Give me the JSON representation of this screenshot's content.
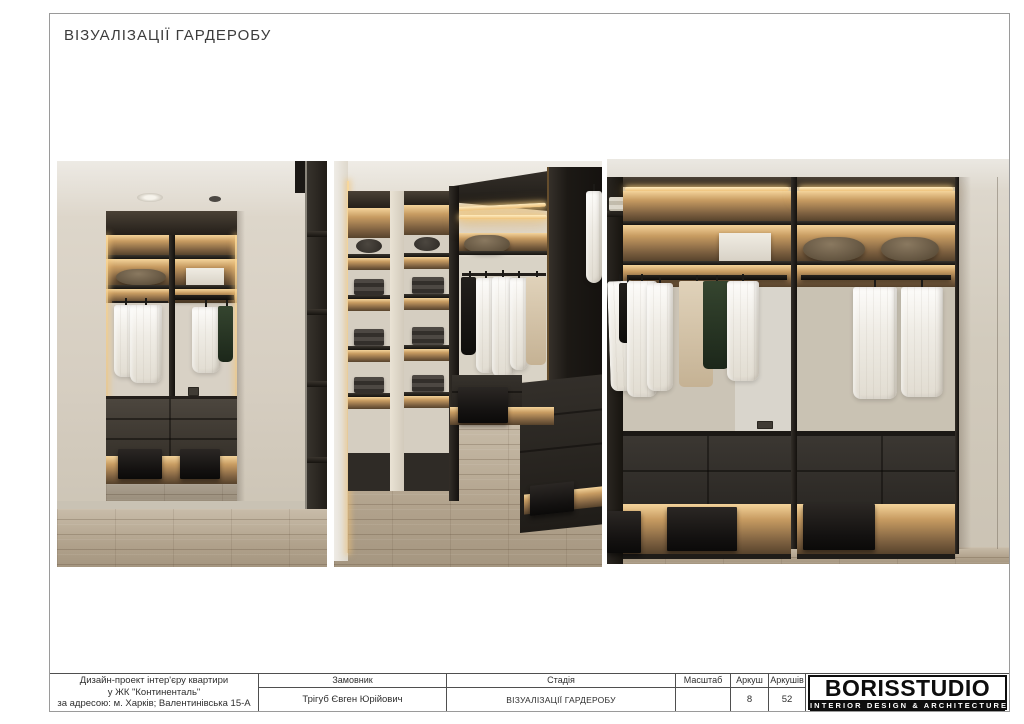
{
  "page": {
    "title": "ВІЗУАЛІЗАЦІЇ ГАРДЕРОБУ"
  },
  "title_block": {
    "project": {
      "line1": "Дизайн-проект інтер'єру квартири",
      "line2": "у ЖК \"Континенталь\"",
      "line3": "за адресою: м. Харків; Валентинівська 15-А"
    },
    "client": {
      "label": "Замовник",
      "value": "Трігуб Євген Юрійович"
    },
    "stage": {
      "label": "Стадія",
      "value": "ВІЗУАЛІЗАЦІЇ ГАРДЕРОБУ"
    },
    "scale": {
      "label": "Масштаб",
      "value": ""
    },
    "sheet": {
      "label": "Аркуш",
      "value": "8"
    },
    "sheets": {
      "label": "Аркушів",
      "value": "52"
    },
    "logo": {
      "name": "BORISSTUDIO",
      "tagline": "INTERIOR DESIGN & ARCHITECTURE"
    }
  },
  "renders": [
    {
      "name": "wardrobe-entrance-mirror-view",
      "description": "Wardrobe seen through a wall opening: backlit shelves, pillows, white shirts on rail, dark drawer unit with lit base niche, wood floor"
    },
    {
      "name": "wardrobe-interior-corner-view",
      "description": "Walk-in wardrobe interior: backlit open shelving with folded clothes, hanging rail with shirts, dark drawer console, wood floor"
    },
    {
      "name": "wardrobe-front-elevation-view",
      "description": "Full wardrobe wall: LED-lit shelves with pillows and box, hanging shirts and jackets, drawer console, illuminated base niche with boxes"
    }
  ],
  "colors": {
    "led_accent": "#eec27c",
    "cabinet_dark": "#2e2a25",
    "wall_cream": "#d6cfc2",
    "floor_wood": "#b1a28c",
    "logo_black": "#0d0d0d"
  }
}
